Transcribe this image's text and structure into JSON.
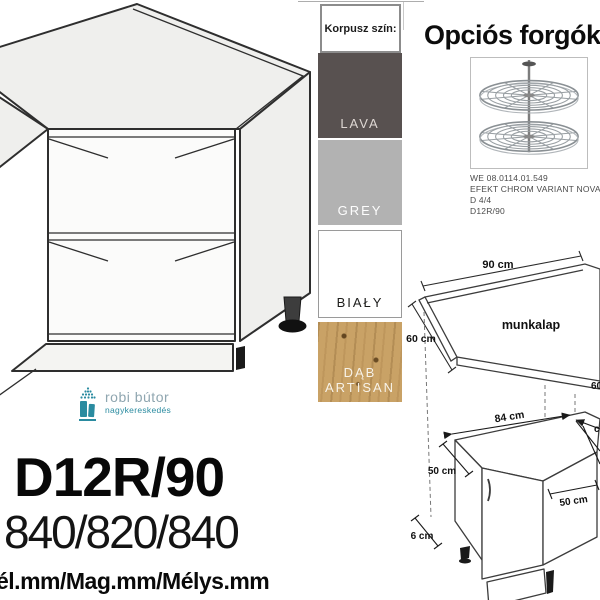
{
  "korpusz": {
    "title": "Korpusz szín:",
    "swatches": [
      {
        "label": "LAVA",
        "color": "#585150"
      },
      {
        "label": "GREY",
        "color": "#b2b2b2"
      },
      {
        "label": "BIAŁY",
        "color": "#ffffff"
      },
      {
        "label": "DĄB ARTISAN",
        "color": "#c9a266"
      }
    ]
  },
  "optional_section": {
    "title": "Opciós forgóko",
    "caption_lines": [
      "WE 08.0114.01.549",
      "EFEKT CHROM VARIANT NOVA D 4/4",
      "D12R/90"
    ]
  },
  "logo": {
    "name": "robi bútor",
    "subtitle": "nagykereskedés",
    "accent_color": "#2a8ba0"
  },
  "product": {
    "code": "D12R/90",
    "dimensions": "840/820/840",
    "dimensions_legend": "él.mm/Mag.mm/Mélys.mm"
  },
  "diagrams": {
    "worktop": {
      "label": "munkalap",
      "width": "90 cm",
      "left_depth": "60 cm",
      "right_depth": "60 cm"
    },
    "cabinet": {
      "back_width": "84 cm",
      "left_width": "50 cm",
      "right_width": "50 cm",
      "plinth_height": "6 cm",
      "right_cut_label": "cm"
    }
  }
}
